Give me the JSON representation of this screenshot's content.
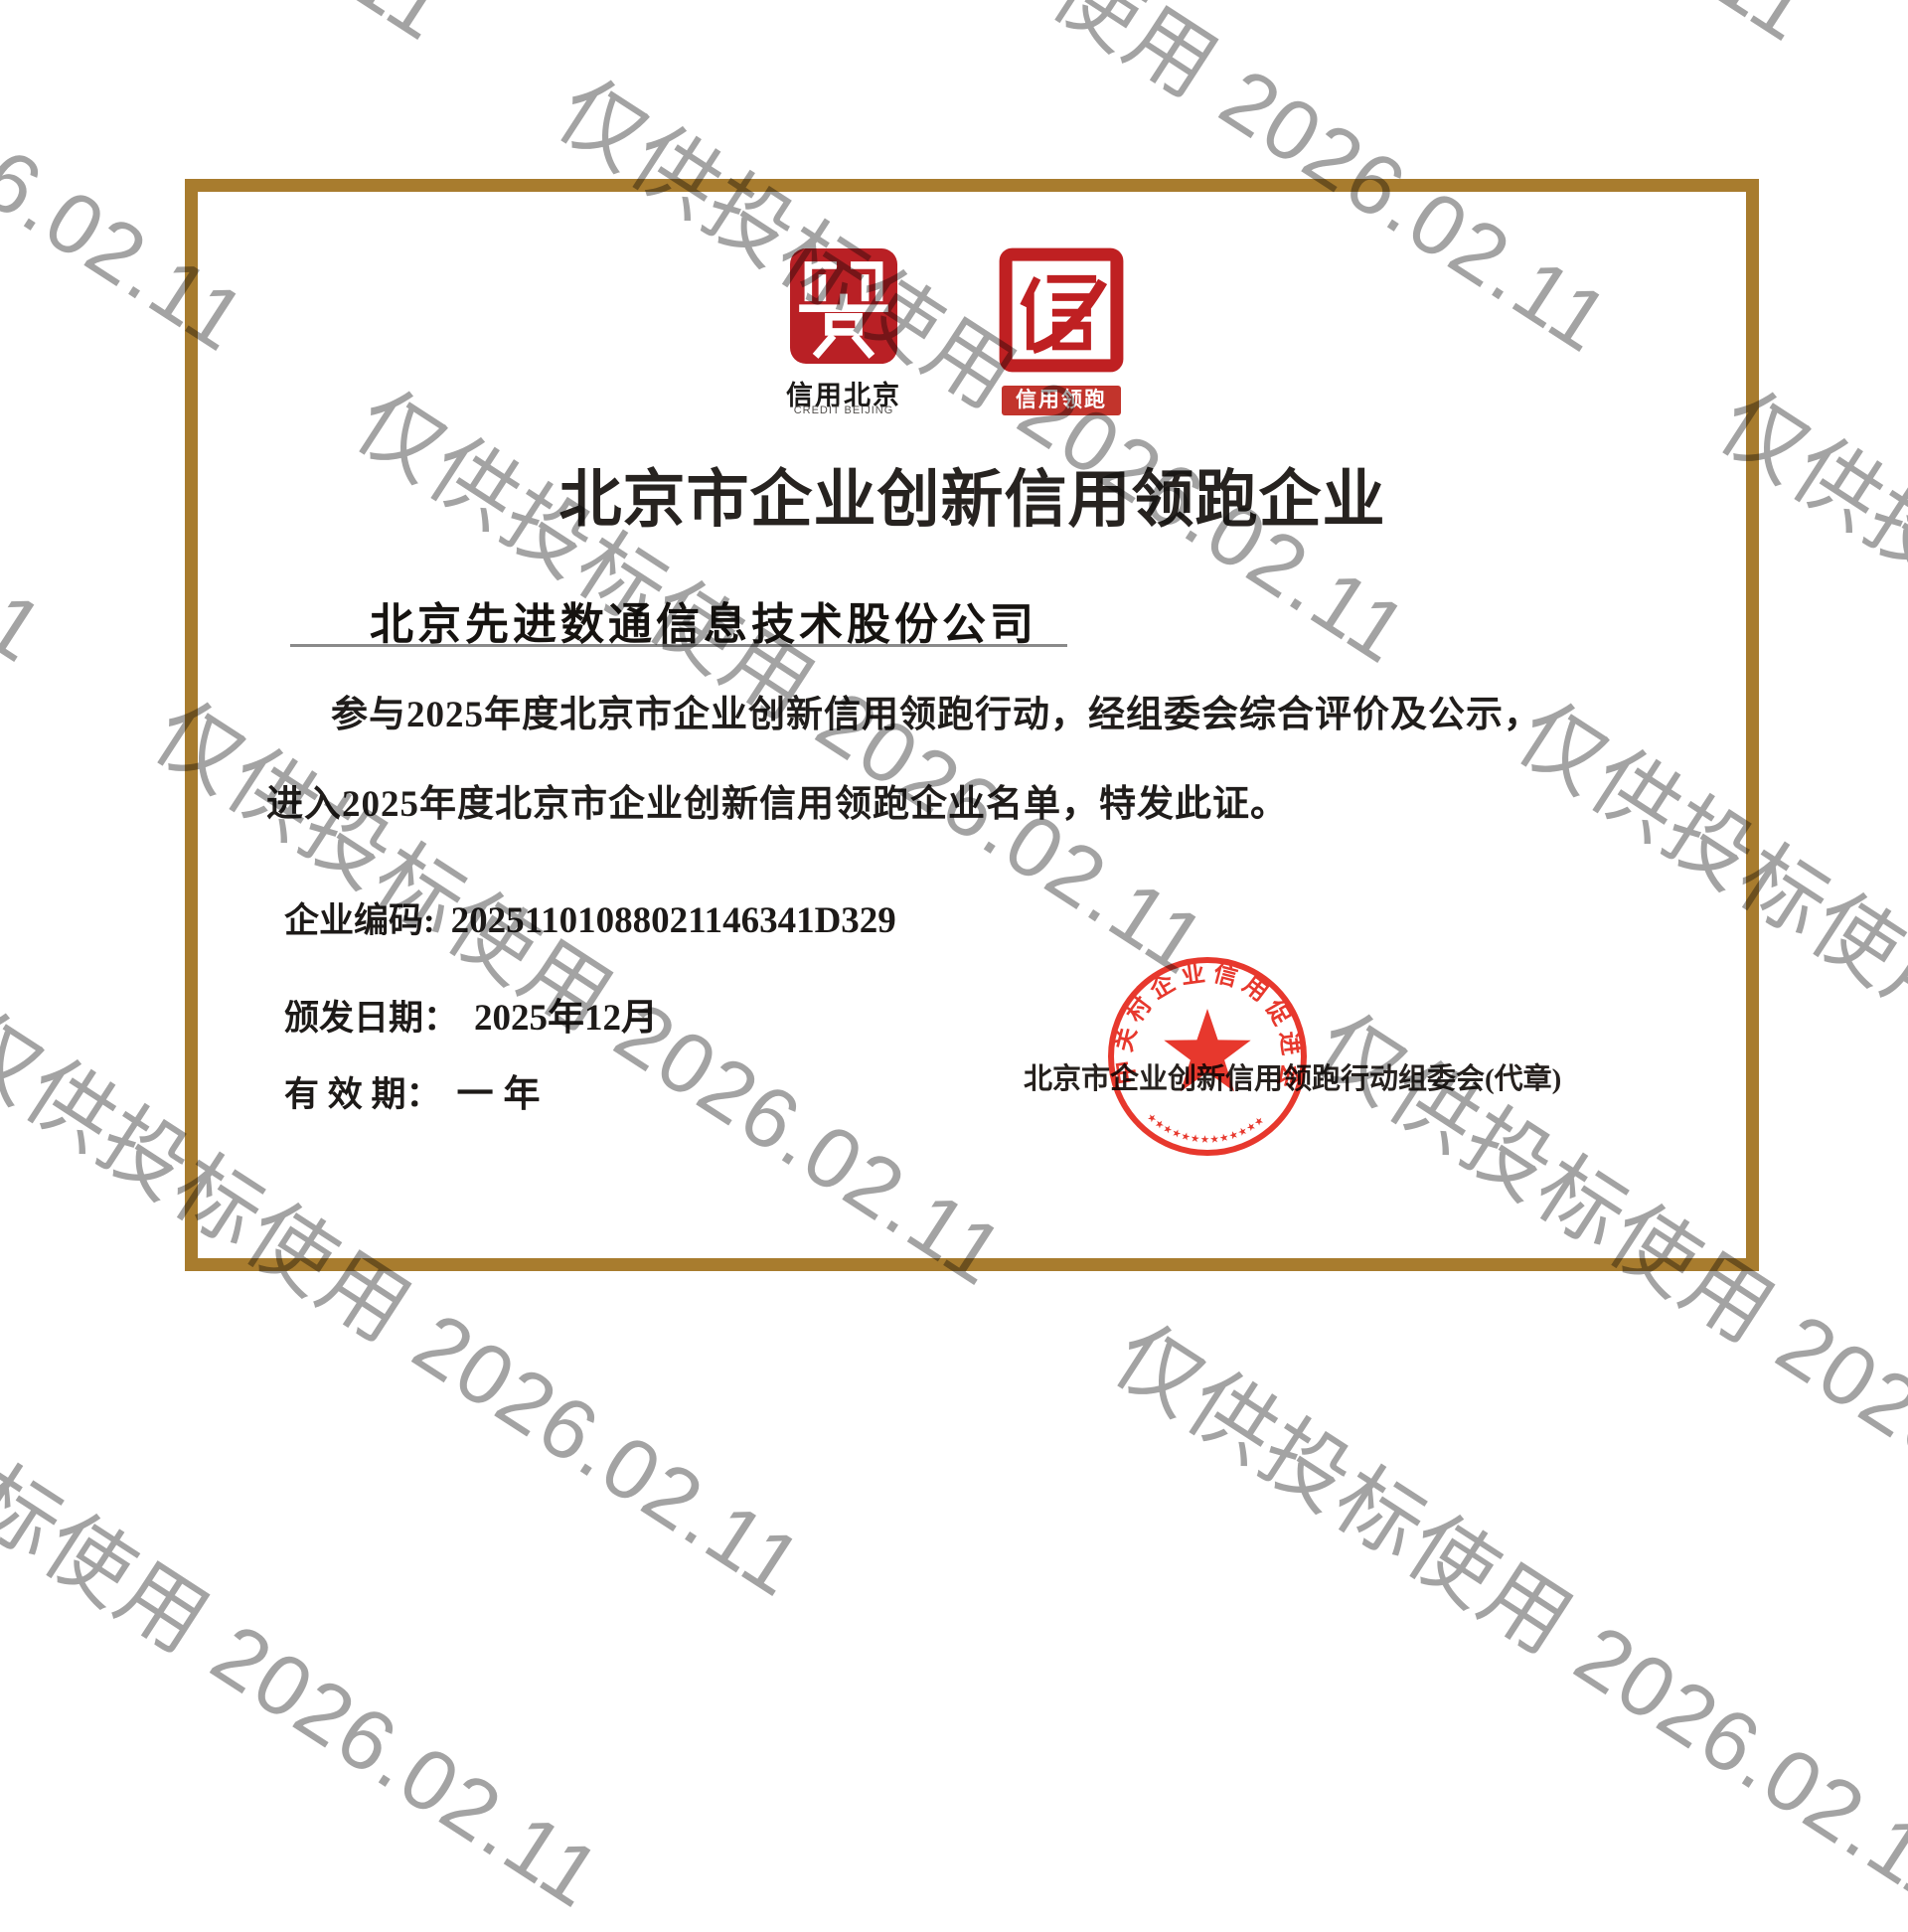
{
  "watermark": {
    "text": "仅供投标使用 2026.02.11"
  },
  "certificate": {
    "logo1": {
      "caption_cn": "信用北京",
      "caption_en": "CREDIT BEIJING"
    },
    "logo2": {
      "caption": "信用领跑"
    },
    "title": "北京市企业创新信用领跑企业",
    "company": "北京先进数通信息技术股份公司",
    "body_line1": "参与2025年度北京市企业创新信用领跑行动，经组委会综合评价及公示，",
    "body_line2": "进入2025年度北京市企业创新信用领跑企业名单，特发此证。",
    "fields": {
      "code_label": "企业编码:",
      "code_value": "20251101088021146341D329",
      "issue_label": "颁发日期：",
      "issue_value": "2025年12月",
      "valid_label": "有 效 期：",
      "valid_value": "一年"
    },
    "issuer": "北京市企业创新信用领跑行动组委会(代章)",
    "seal": {
      "ring_text": "中关村企业信用促进会",
      "bottom_marks": "★★★★★★★★★★★★★"
    },
    "colors": {
      "frame_gold": "#a87c2e",
      "logo_red": "#b92025",
      "seal_red": "#e5271b",
      "watermark_gray": "#8c8c8c"
    }
  }
}
